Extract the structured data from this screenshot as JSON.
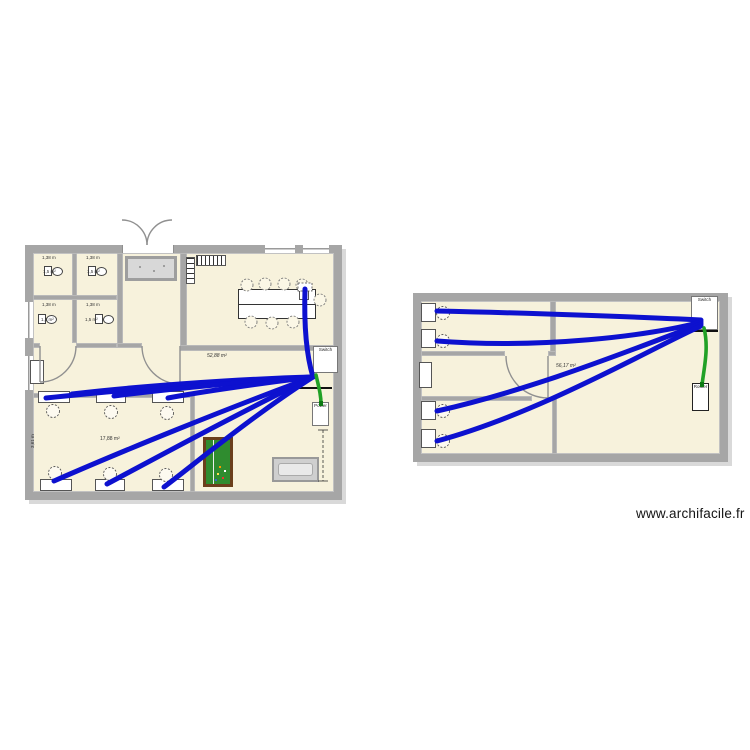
{
  "watermark": "www.archifacile.fr",
  "palette": {
    "wall": "#a6a6a6",
    "floor": "#f7f2dc",
    "cable_blue": "#0d11cf",
    "cable_green": "#21a126"
  },
  "ground_floor": {
    "rooms": {
      "wc1": {
        "width": "1,38 m",
        "area": "1,5 m²"
      },
      "wc2": {
        "width": "1,38 m",
        "area": "1,5 m²"
      },
      "wc3": {
        "width": "1,38 m",
        "area": "1,5 m²"
      },
      "wc4": {
        "width": "1,38 m",
        "area": "1,5 m²"
      },
      "living": {
        "area": "52,88 m²"
      },
      "bedroom": {
        "area": "17,88 m²",
        "height": "3,61 m"
      }
    },
    "network": {
      "switch": "Switch",
      "power": "Power"
    }
  },
  "first_floor": {
    "rooms": {
      "main": {
        "area": "56,17 m²"
      }
    },
    "network": {
      "switch": "Switch",
      "router": "Router"
    }
  }
}
